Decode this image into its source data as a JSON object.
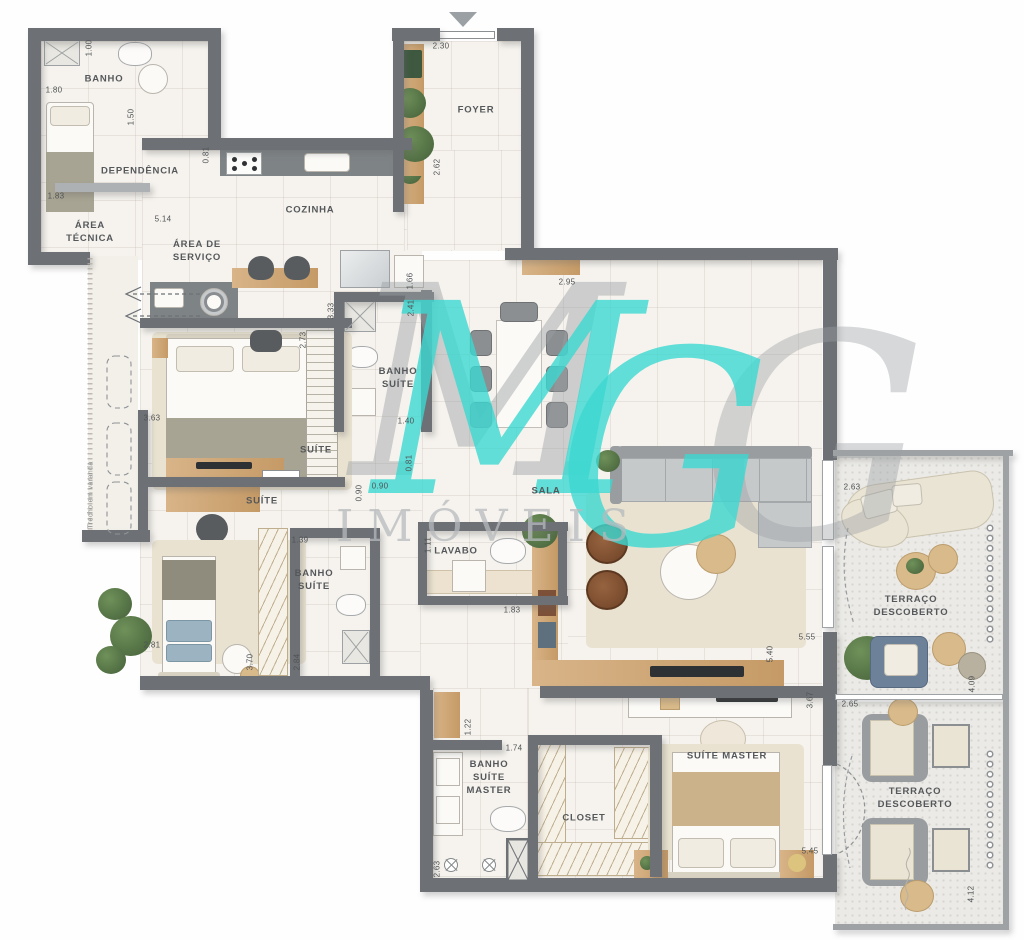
{
  "watermark": {
    "m": "M",
    "g": "G",
    "sub": "IMÓVEIS"
  },
  "colors": {
    "wall": "#6d7175",
    "floor": "#f6f3ee",
    "terrace_floor": "#ebeae6",
    "wood": "#cda776",
    "watermark_teal": "#3cd9d2",
    "watermark_gray": "#9ba0a4",
    "label_text": "#55585b"
  },
  "rooms": [
    {
      "id": "banho-dependencia",
      "label": "BANHO",
      "x": 104,
      "y": 80
    },
    {
      "id": "dependencia",
      "label": "DEPENDÊNCIA",
      "x": 140,
      "y": 172
    },
    {
      "id": "area-tecnica",
      "label": "ÁREA\nTÉCNICA",
      "x": 90,
      "y": 233
    },
    {
      "id": "area-de-servico",
      "label": "ÁREA DE\nSERVIÇO",
      "x": 197,
      "y": 252
    },
    {
      "id": "cozinha",
      "label": "COZINHA",
      "x": 310,
      "y": 211
    },
    {
      "id": "foyer",
      "label": "FOYER",
      "x": 476,
      "y": 111
    },
    {
      "id": "banho-suite-1",
      "label": "BANHO\nSUÍTE",
      "x": 398,
      "y": 379
    },
    {
      "id": "suite-1",
      "label": "SUÍTE",
      "x": 316,
      "y": 451
    },
    {
      "id": "suite-2",
      "label": "SUÍTE",
      "x": 262,
      "y": 502
    },
    {
      "id": "banho-suite-2",
      "label": "BANHO\nSUÍTE",
      "x": 314,
      "y": 581
    },
    {
      "id": "sala",
      "label": "SALA",
      "x": 546,
      "y": 492
    },
    {
      "id": "lavabo",
      "label": "LAVABO",
      "x": 456,
      "y": 552
    },
    {
      "id": "suite-master",
      "label": "SUÍTE MASTER",
      "x": 727,
      "y": 757
    },
    {
      "id": "banho-suite-master",
      "label": "BANHO\nSUÍTE\nMASTER",
      "x": 489,
      "y": 778
    },
    {
      "id": "closet",
      "label": "CLOSET",
      "x": 584,
      "y": 819
    },
    {
      "id": "terraco-descoberto-1",
      "label": "TERRAÇO DESCOBERTO",
      "x": 911,
      "y": 607
    },
    {
      "id": "terraco-descoberto-2",
      "label": "TERRAÇO DESCOBERTO",
      "x": 915,
      "y": 799
    },
    {
      "id": "trecho-em-varanda",
      "label": "Trecho em varanda",
      "x": 91,
      "y": 495,
      "rot": 90,
      "small": true
    }
  ],
  "dimensions": [
    {
      "v": "1.00",
      "x": 89,
      "y": 48,
      "rot": 90
    },
    {
      "v": "1.80",
      "x": 54,
      "y": 90,
      "rot": 0
    },
    {
      "v": "1.50",
      "x": 131,
      "y": 117,
      "rot": 90
    },
    {
      "v": "1.83",
      "x": 56,
      "y": 196,
      "rot": 0
    },
    {
      "v": "0.81",
      "x": 206,
      "y": 155,
      "rot": 90
    },
    {
      "v": "5.14",
      "x": 163,
      "y": 219,
      "rot": 0
    },
    {
      "v": "2.30",
      "x": 441,
      "y": 46,
      "rot": 0
    },
    {
      "v": "2.62",
      "x": 437,
      "y": 167,
      "rot": 90
    },
    {
      "v": "2.95",
      "x": 567,
      "y": 282,
      "rot": 0
    },
    {
      "v": "1.66",
      "x": 410,
      "y": 281,
      "rot": 90
    },
    {
      "v": "2.41",
      "x": 411,
      "y": 308,
      "rot": 90
    },
    {
      "v": "3.33",
      "x": 331,
      "y": 311,
      "rot": 90
    },
    {
      "v": "2.73",
      "x": 303,
      "y": 340,
      "rot": 90
    },
    {
      "v": "3.63",
      "x": 152,
      "y": 418,
      "rot": 0
    },
    {
      "v": "1.40",
      "x": 406,
      "y": 421,
      "rot": 0
    },
    {
      "v": "0.81",
      "x": 409,
      "y": 463,
      "rot": 90
    },
    {
      "v": "0.90",
      "x": 380,
      "y": 486,
      "rot": 0
    },
    {
      "v": "0.90",
      "x": 359,
      "y": 493,
      "rot": 90
    },
    {
      "v": "1.39",
      "x": 300,
      "y": 540,
      "rot": 0
    },
    {
      "v": "2.81",
      "x": 152,
      "y": 645,
      "rot": 0
    },
    {
      "v": "3.70",
      "x": 250,
      "y": 662,
      "rot": 90
    },
    {
      "v": "2.84",
      "x": 297,
      "y": 662,
      "rot": 90
    },
    {
      "v": "1.11",
      "x": 428,
      "y": 545,
      "rot": 90
    },
    {
      "v": "1.83",
      "x": 512,
      "y": 610,
      "rot": 0
    },
    {
      "v": "1.22",
      "x": 468,
      "y": 727,
      "rot": 90
    },
    {
      "v": "1.74",
      "x": 514,
      "y": 748,
      "rot": 0
    },
    {
      "v": "2.63",
      "x": 437,
      "y": 869,
      "rot": 90
    },
    {
      "v": "5.55",
      "x": 807,
      "y": 637,
      "rot": 0
    },
    {
      "v": "5.40",
      "x": 770,
      "y": 654,
      "rot": 90
    },
    {
      "v": "3.67",
      "x": 810,
      "y": 700,
      "rot": 90
    },
    {
      "v": "2.63",
      "x": 852,
      "y": 487,
      "rot": 0
    },
    {
      "v": "4.09",
      "x": 972,
      "y": 684,
      "rot": 90
    },
    {
      "v": "2.65",
      "x": 850,
      "y": 704,
      "rot": 0
    },
    {
      "v": "5.45",
      "x": 810,
      "y": 851,
      "rot": 0
    },
    {
      "v": "4.12",
      "x": 971,
      "y": 894,
      "rot": 90
    }
  ]
}
